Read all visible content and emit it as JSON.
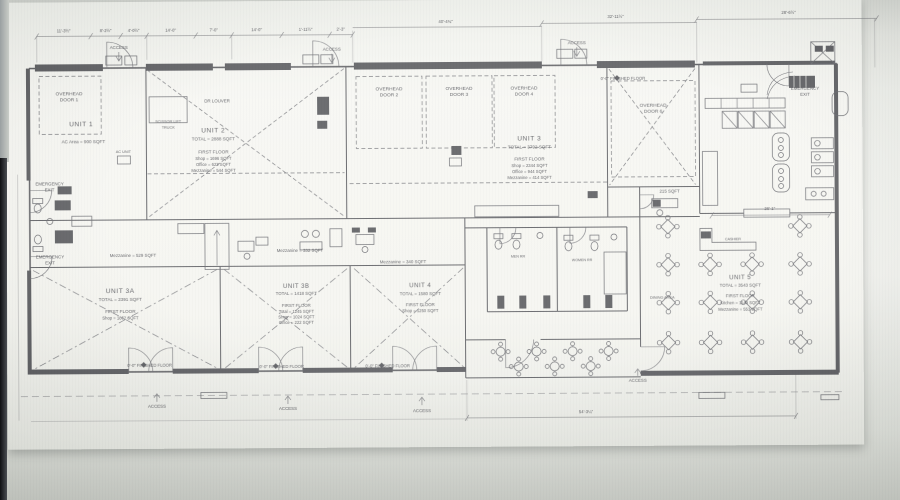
{
  "plan": {
    "units": {
      "unit1": {
        "name": "UNIT 1",
        "area": "AC Area = 900 SQFT"
      },
      "unit2": {
        "name": "UNIT 2",
        "total": "TOTAL = 2888 SQFT",
        "floor": "FIRST FLOOR",
        "lines": [
          "Shop = 1696 SQFT",
          "Office = 623 SQFT",
          "Mezzanine = 544 SQFT"
        ]
      },
      "unit3": {
        "name": "UNIT 3",
        "total": "TOTAL = 3792 SQFT",
        "floor": "FIRST FLOOR",
        "lines": [
          "Shop = 2344 SQFT",
          "Office = 944 SQFT",
          "Mezzanine = 414 SQFT"
        ]
      },
      "unit3a": {
        "name": "UNIT 3A",
        "total": "TOTAL = 2391 SQFT",
        "floor": "FIRST FLOOR",
        "lines": [
          "Shop = 1862 SQFT"
        ],
        "mezzanine": "Mezzanine = 529 SQFT"
      },
      "unit3b": {
        "name": "UNIT 3B",
        "total": "TOTAL = 1418 SQFT",
        "floor": "FIRST FLOOR",
        "lines": [
          "Total = 1245 SQFT",
          "Shop = 1024 SQFT",
          "Office = 222 SQFT"
        ],
        "mezzanine": "Mezzanine = 332 SQFT"
      },
      "unit4": {
        "name": "UNIT 4",
        "total": "TOTAL = 1580 SQFT",
        "floor": "FIRST FLOOR",
        "lines": [
          "Shop = 1250 SQFT"
        ],
        "mezzanine": "Mezzanine = 340 SQFT"
      },
      "unit5": {
        "name": "UNIT 5",
        "total": "TOTAL = 3543 SQFT",
        "floor": "FIRST FLOOR",
        "lines": [
          "Kitchen = 1149 SQFT",
          "Mezzanine = 553 SQFT"
        ]
      }
    },
    "doors": {
      "prefix": "OVERHEAD",
      "door1": "DOOR 1",
      "door2": "DOOR 2",
      "door3": "DOOR 3",
      "door4": "DOOR 4",
      "door6": "DOOR 6"
    },
    "labels": {
      "access": "ACCESS",
      "emergency1": "EMERGENCY",
      "emergency2": "EXIT",
      "finished_floor": "0'-0\" FINISHED FLOOR",
      "dr_louver": "DR LOUVER",
      "scissor1": "SCISSOR LIFT",
      "scissor2": "TRUCK",
      "ac_unit": "AC UNIT",
      "room215": "215 SQFT",
      "dining_area": "DINING AREA",
      "cashier": "CASHIER",
      "men_rr": "MEN RR",
      "women_rr": "WOMEN RR"
    },
    "dimensions": {
      "top": [
        "11'-3½\"",
        "8'-2½\"",
        "4'-0½\"",
        "14'-0\"",
        "7'-0\"",
        "14'-0\"",
        "1'-11½\"",
        "2'-3\""
      ],
      "top2": [
        "40'-4¾\"",
        "32'-11½\"",
        "28'-6½\""
      ],
      "bottom": "54'-3¼\"",
      "kitchen": "26'-1\""
    }
  }
}
